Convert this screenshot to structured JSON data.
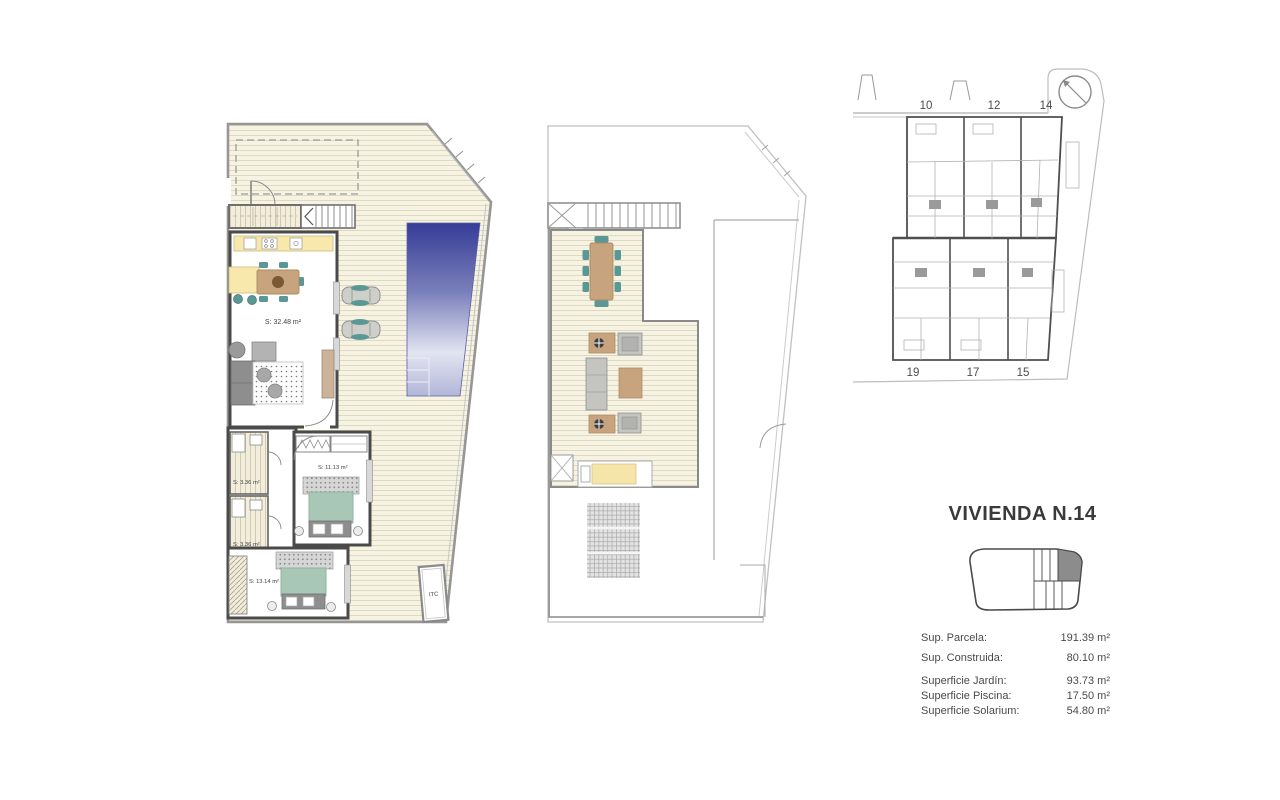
{
  "info_panel": {
    "title": "VIVIENDA N.14",
    "measurements": [
      {
        "label": "Sup. Parcela:",
        "value": "191.39 m²"
      },
      {
        "label": "Sup. Construida:",
        "value": "80.10 m²"
      },
      {
        "label": "Superficie Jardín:",
        "value": "93.73 m²"
      },
      {
        "label": "Superficie Piscina:",
        "value": "17.50 m²"
      },
      {
        "label": "Superficie Solarium:",
        "value": "54.80 m²"
      }
    ]
  },
  "ground_floor_plan": {
    "labels": {
      "living_kitchen": "S: 32.48 m²",
      "bathroom_1": "S: 3.36 m²",
      "bathroom_2": "S: 3.36 m²",
      "bedroom_1": "S: 11.13 m²",
      "bedroom_2": "S: 13.14 m²",
      "itc": "ITC"
    }
  },
  "site_plan": {
    "top_unit_numbers": [
      "10",
      "12",
      "14"
    ],
    "bottom_unit_numbers": [
      "19",
      "17",
      "15"
    ]
  },
  "colors": {
    "pool_deep": "#363c96",
    "pool_mid": "#7a80bb",
    "pool_pale": "#e2e4f1",
    "pool_foot": "#b2b6d8",
    "deck_base": "#f7f3e3",
    "accent_teal": "#5b9794",
    "bed_sage": "#a9c7b6",
    "kitchen_yellow": "#f8e8ab",
    "furniture_tan": "#c8a47e",
    "wall_dark": "#4a4a4a",
    "keyplan_highlight": "#8c8c8c"
  }
}
